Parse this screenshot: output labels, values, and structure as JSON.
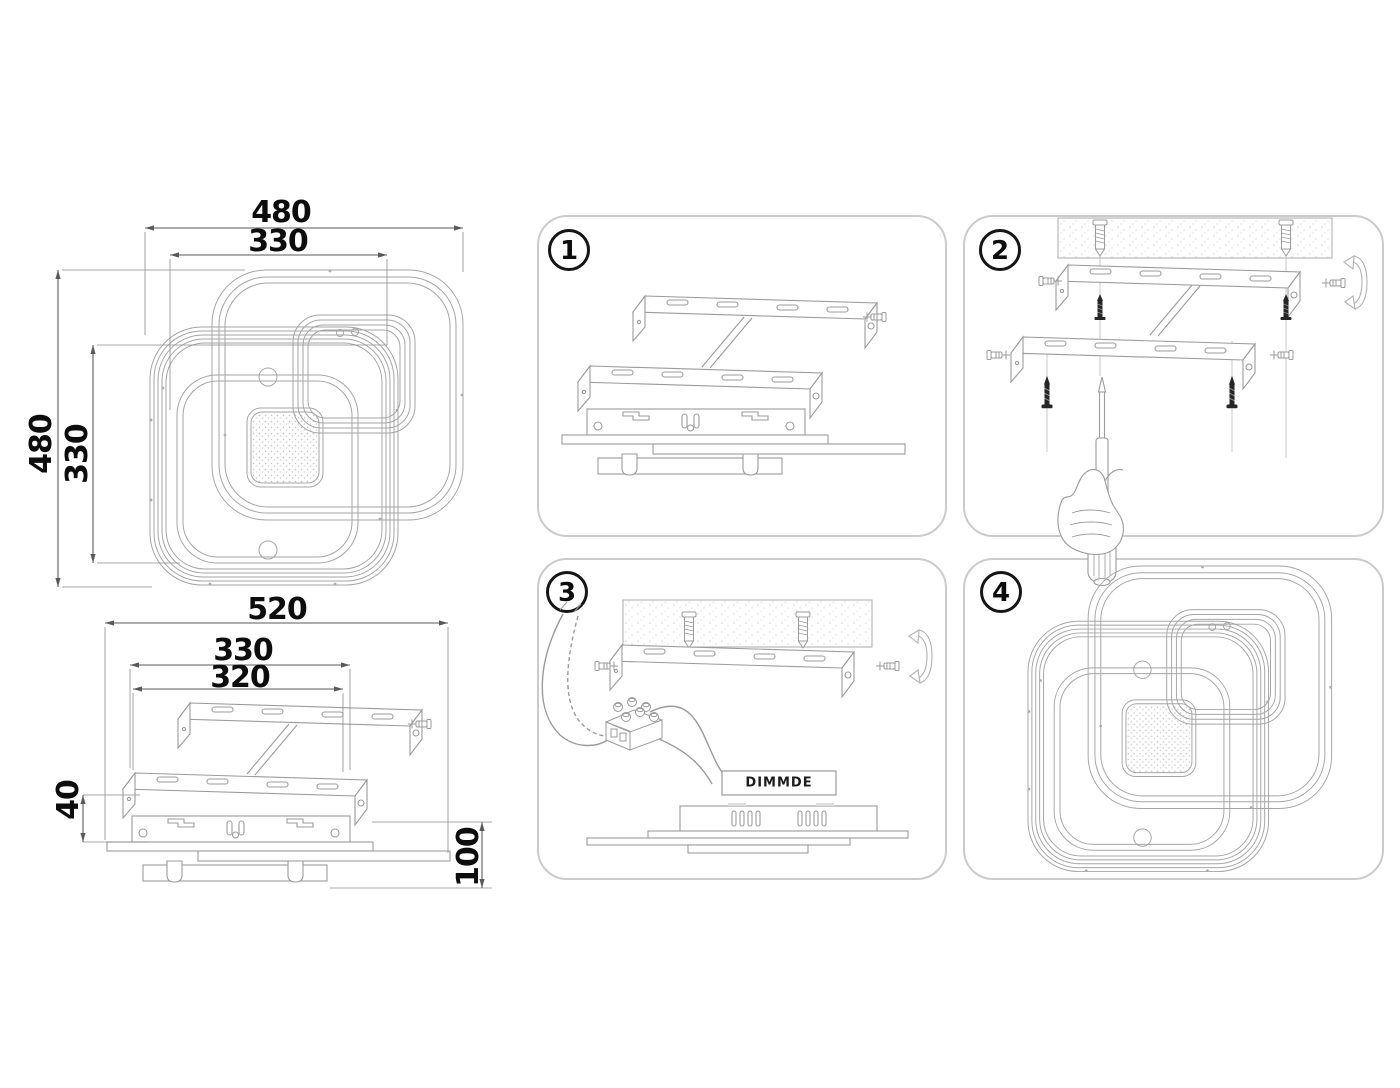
{
  "drawings": {
    "top_view": {
      "width_outer": "480",
      "width_inner": "330",
      "height_outer": "480",
      "height_inner": "330"
    },
    "side_view": {
      "width_total": "520",
      "width_bracket_outer": "330",
      "width_bracket_slots": "320",
      "height_bracket": "40",
      "height_total": "100"
    }
  },
  "steps": [
    {
      "number": "1"
    },
    {
      "number": "2"
    },
    {
      "number": "3"
    },
    {
      "number": "4"
    }
  ],
  "labels": {
    "driver": "DIMMDE"
  },
  "colors": {
    "background": "#ffffff",
    "drawing_line": "#9b9b9b",
    "dimension_line": "#5a5a5a",
    "text": "#0d0d0d",
    "panel_border": "#cbcbcb",
    "dark_part": "#262626"
  }
}
